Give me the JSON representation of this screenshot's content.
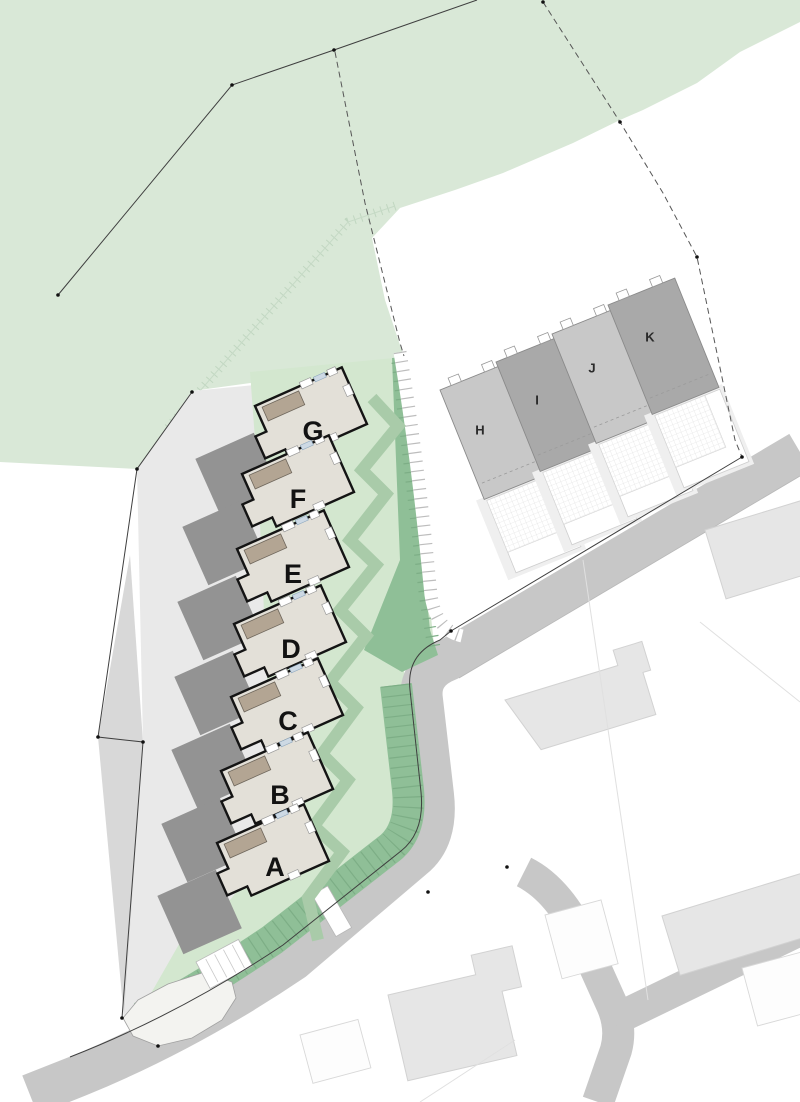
{
  "plan": {
    "new_plots": [
      {
        "label": "G"
      },
      {
        "label": "F"
      },
      {
        "label": "E"
      },
      {
        "label": "D"
      },
      {
        "label": "C"
      },
      {
        "label": "B"
      },
      {
        "label": "A"
      }
    ],
    "existing_plots": [
      {
        "label": "H"
      },
      {
        "label": "I"
      },
      {
        "label": "J"
      },
      {
        "label": "K"
      }
    ],
    "colors": {
      "field_green": "#d9e8d7",
      "lawn_green": "#d3e7cf",
      "path_green": "#a9cba9",
      "bank_green": "#8fbf97",
      "bank_tick": "#7dae86",
      "road_gray": "#c7c7c7",
      "lane_gray": "#d8d8d8",
      "paving_gray": "#e9e9e9",
      "house_fill": "#e3e0d8",
      "house_outline": "#141414",
      "canopy_tan": "#b3a593",
      "block_gray": "#939393",
      "unit_light": "#c8c8c8",
      "unit_dark": "#a9a9a9"
    }
  }
}
